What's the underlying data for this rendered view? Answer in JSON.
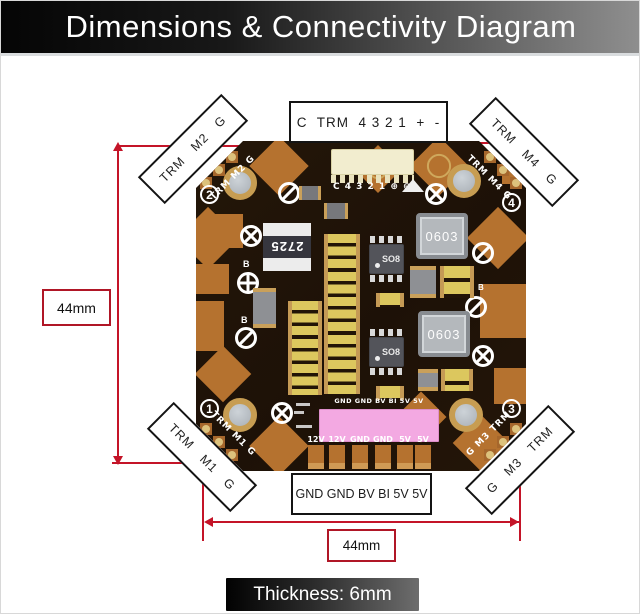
{
  "header": {
    "title": "Dimensions & Connectivity Diagram"
  },
  "dimensions": {
    "height": "44mm",
    "width": "44mm",
    "thickness": "Thickness: 6mm"
  },
  "connector_labels": {
    "top": "C  TRM  4 3 2 1  +  -",
    "bottom": "GND GND BV BI 5V 5V"
  },
  "corner_tags": {
    "tl": {
      "words": [
        "TRM",
        "M2",
        "G"
      ]
    },
    "tr": {
      "words": [
        "TRM",
        "M4",
        "G"
      ]
    },
    "bl": {
      "words": [
        "TRM",
        "M1",
        "G"
      ]
    },
    "br": {
      "words": [
        "G",
        "M3",
        "TRM"
      ]
    }
  },
  "board": {
    "silk": {
      "tl": "TRM M2 G",
      "tr": "TRM M4 G",
      "bl": "TRM M1 G",
      "br": "G M3 TRM",
      "num_tl": "2",
      "num_tr": "4",
      "num_bl": "1",
      "num_br": "3",
      "connector": "C 4 3 2 1 ⊕ ⊖",
      "above_pink": "GND GND BV BI 5V 5V",
      "bottom_pads": [
        "12V",
        "12V",
        "GND",
        "GND",
        "5V",
        "5V"
      ],
      "b_marker": "B"
    },
    "components": {
      "part_2725": "2725",
      "so8": "SO8",
      "inductor_0603": "0603"
    },
    "colors": {
      "substrate": "#1d1107",
      "copper": "#b5722f",
      "gold_pad": "#ddc27c",
      "pink_component": "#f3a9e2",
      "dimension_red": "#c41428"
    }
  }
}
